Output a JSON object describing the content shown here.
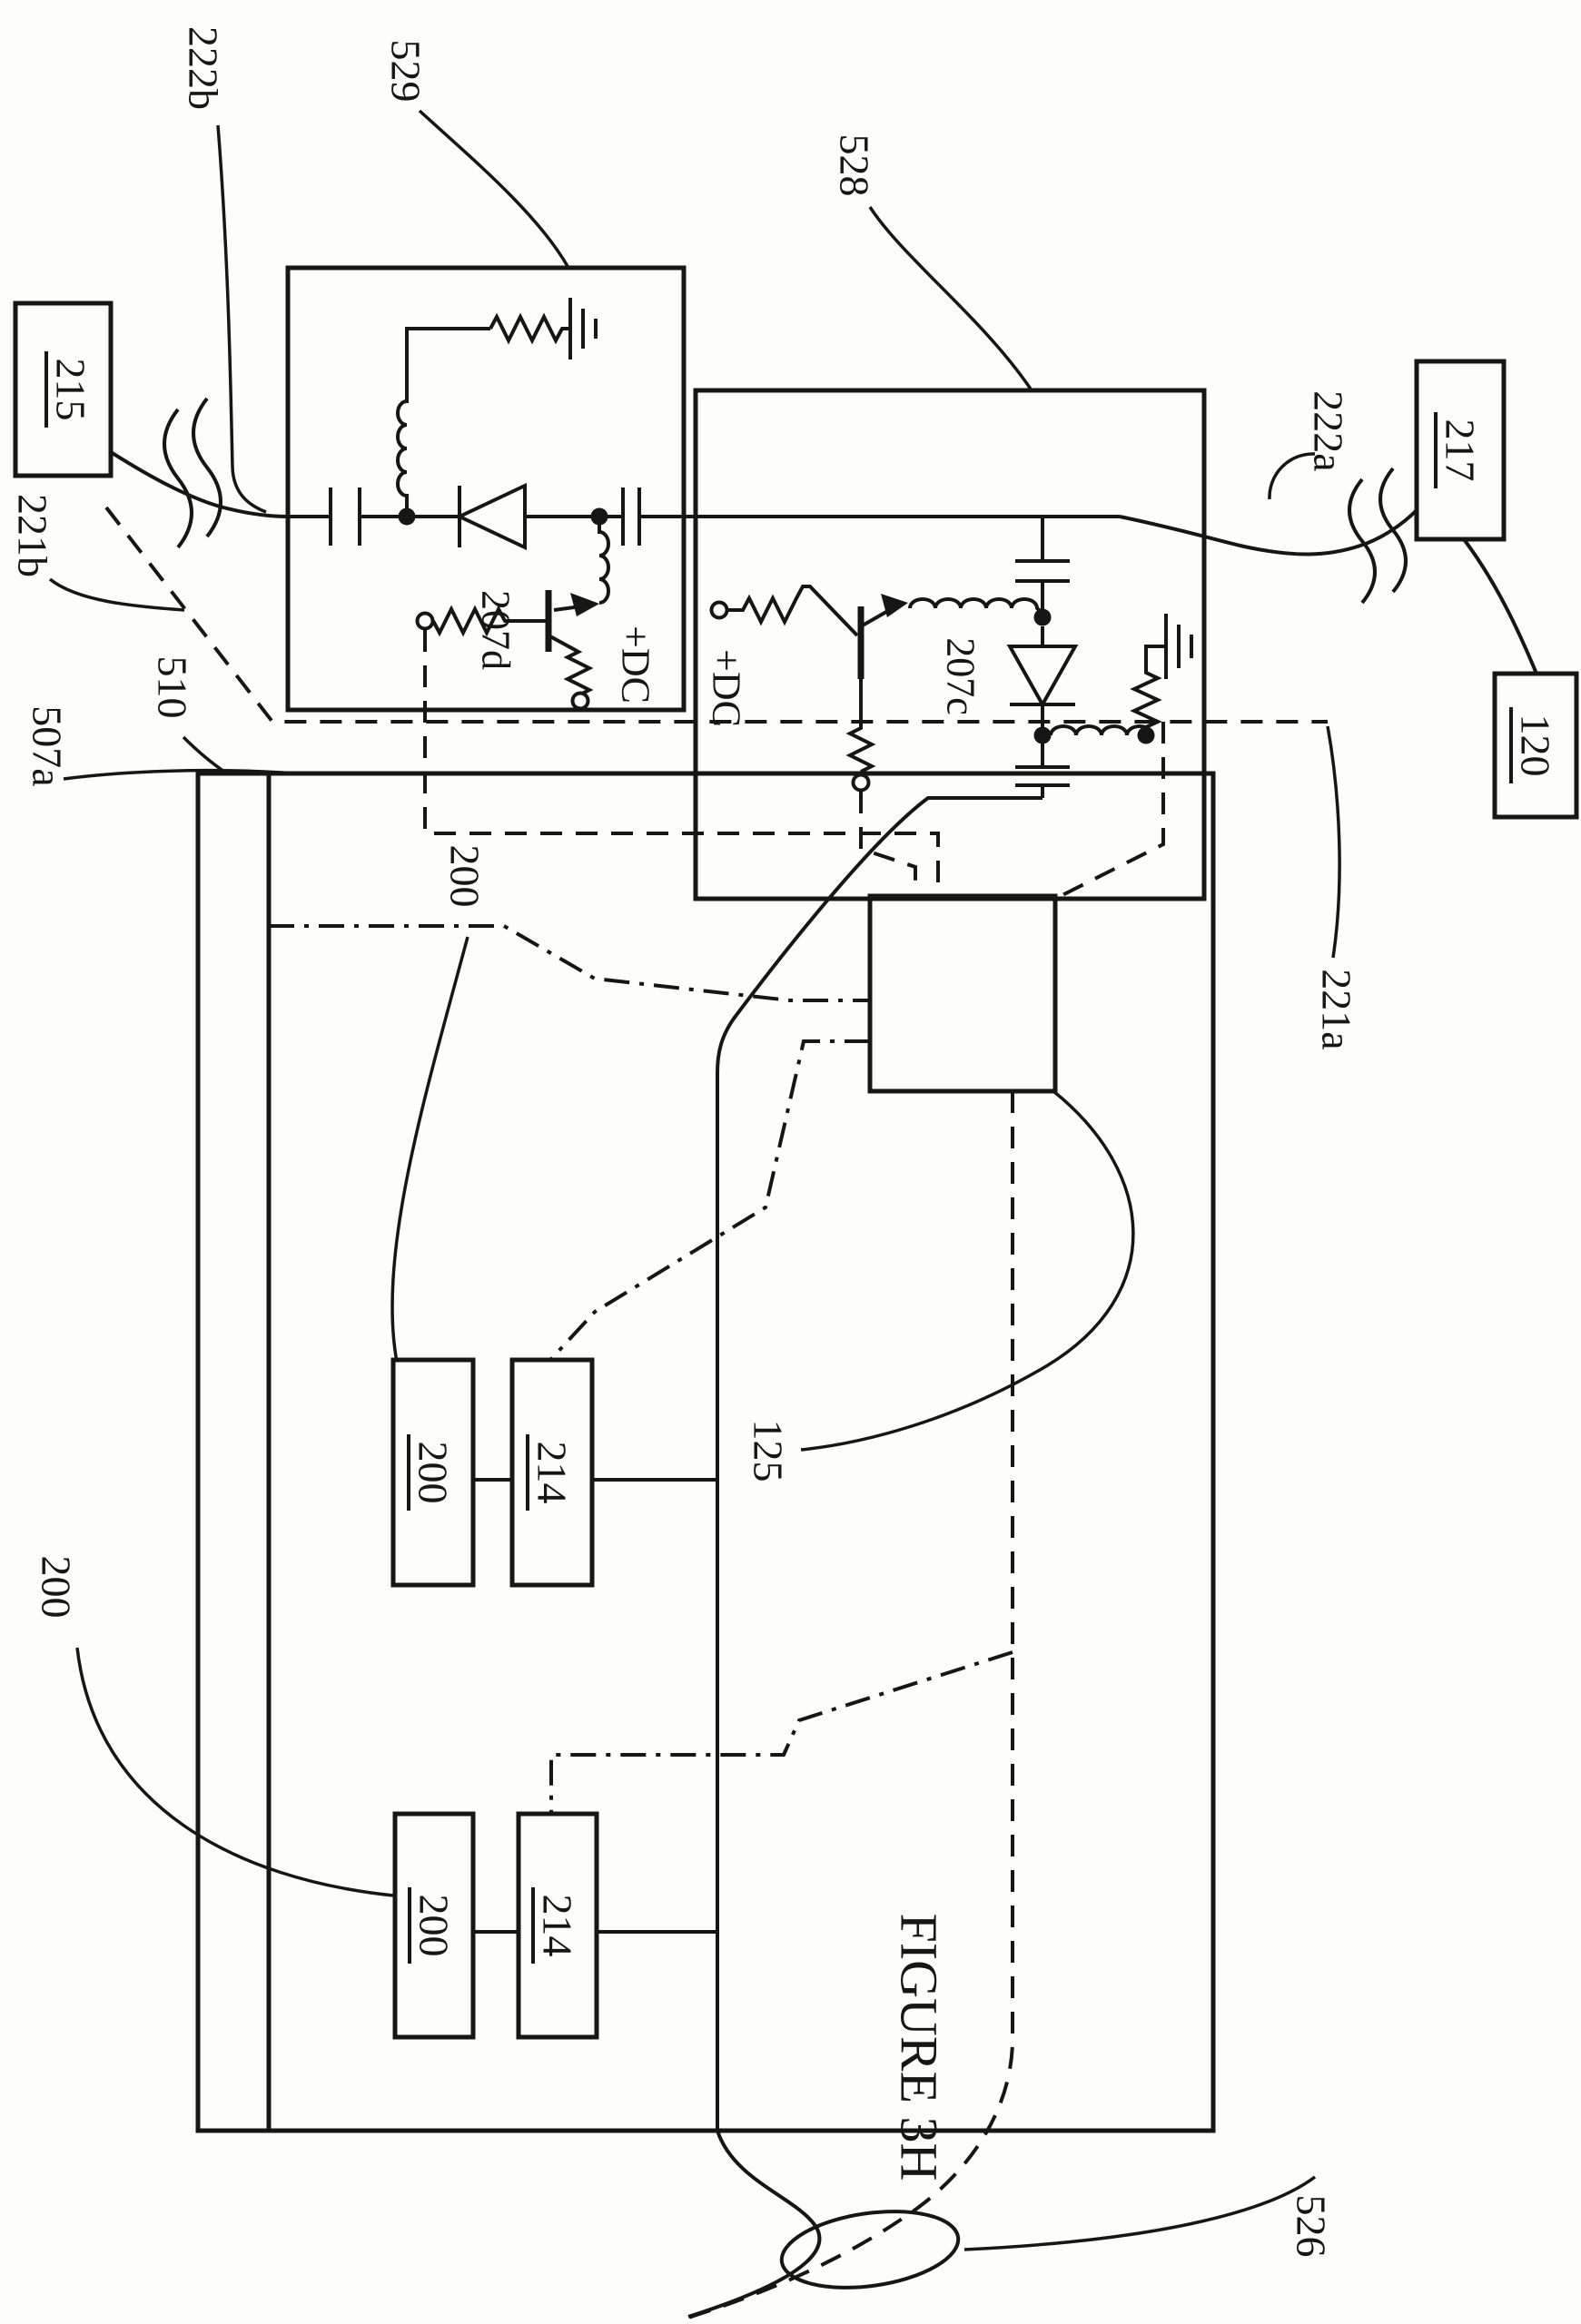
{
  "figure_title": "FIGURE 3H",
  "colors": {
    "ink": "#161616",
    "paper": "#fdfdfb"
  },
  "refs": {
    "r222b": "222b",
    "r529": "529",
    "r528": "528",
    "r222a": "222a",
    "r221b": "221b",
    "r507a": "507a",
    "r510": "510",
    "r221a": "221a",
    "r125": "125",
    "r526": "526",
    "r200_float_top": "200",
    "r200_float_bottom": "200"
  },
  "boxed_refs": {
    "b215": "215",
    "b217": "217",
    "b120": "120",
    "module1": {
      "n200": "200",
      "n214": "214"
    },
    "module2": {
      "n200": "200",
      "n214": "214"
    }
  },
  "component_labels": {
    "dc_529": "+DC",
    "dc_528": "+DC",
    "diode_529": "207d",
    "diode_528": "207c"
  },
  "icons": {
    "capacitor-icon": "two parallel plate bars",
    "inductor-icon": "loop coil",
    "resistor-icon": "zigzag",
    "diode-icon": "open triangle with cathode bar",
    "transistor-icon": "bar with angled emitter/collector and filled arrow",
    "ground-icon": "three shrinking bars",
    "node-dot-icon": "filled junction dot",
    "terminal-icon": "open circle",
    "break-squiggle-icon": "double wavy line break",
    "probe-coil-icon": "ellipse with crossing solid and dashed curves"
  }
}
